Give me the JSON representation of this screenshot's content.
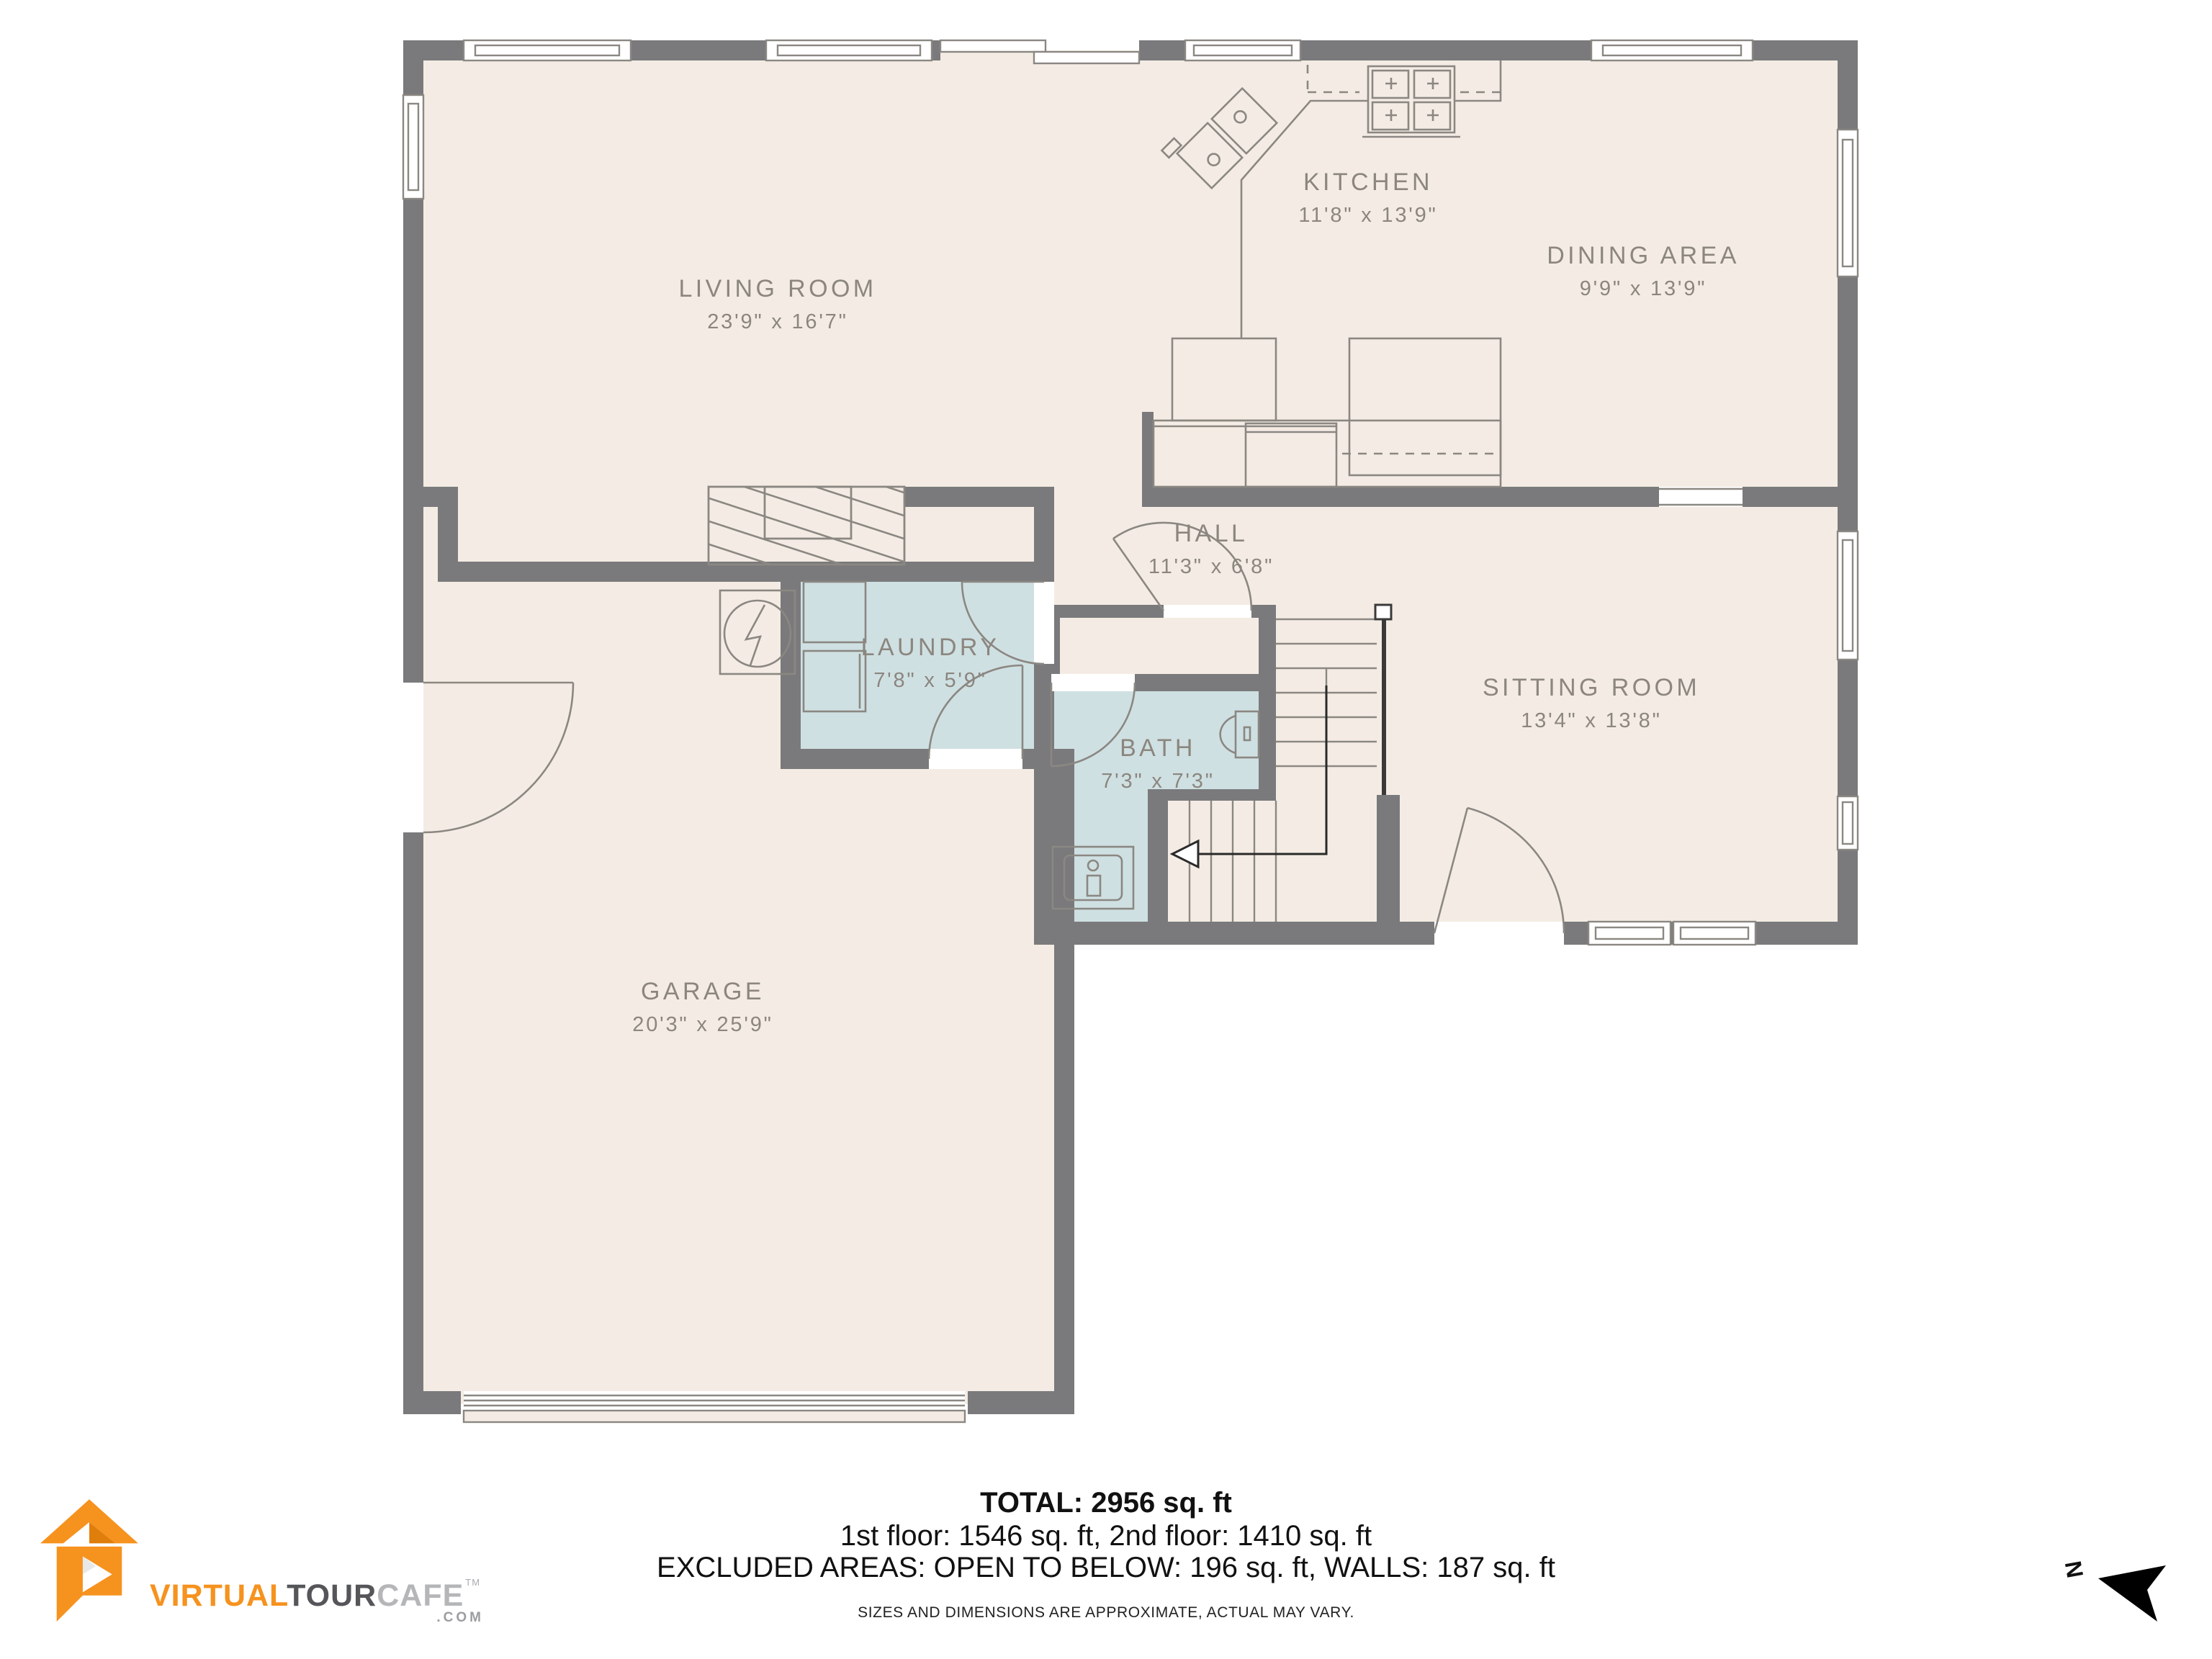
{
  "rooms": [
    {
      "id": "living-room",
      "label": "LIVING ROOM",
      "dims": "23'9\" x 16'7\""
    },
    {
      "id": "kitchen",
      "label": "KITCHEN",
      "dims": "11'8\" x 13'9\""
    },
    {
      "id": "dining-area",
      "label": "DINING AREA",
      "dims": "9'9\" x 13'9\""
    },
    {
      "id": "hall",
      "label": "HALL",
      "dims": "11'3\" x 6'8\""
    },
    {
      "id": "laundry",
      "label": "LAUNDRY",
      "dims": "7'8\" x 5'9\""
    },
    {
      "id": "bath",
      "label": "BATH",
      "dims": "7'3\" x 7'3\""
    },
    {
      "id": "sitting-room",
      "label": "SITTING ROOM",
      "dims": "13'4\" x 13'8\""
    },
    {
      "id": "garage",
      "label": "GARAGE",
      "dims": "20'3\" x 25'9\""
    }
  ],
  "footer": {
    "total": "TOTAL: 2956 sq. ft",
    "floors": "1st floor: 1546 sq. ft, 2nd floor: 1410 sq. ft",
    "excluded": "EXCLUDED AREAS: OPEN TO BELOW: 196 sq. ft, WALLS: 187 sq. ft",
    "disclaimer": "SIZES AND DIMENSIONS ARE APPROXIMATE, ACTUAL MAY VARY."
  },
  "logo": {
    "virtual": "VIRTUAL",
    "tour": "TOUR",
    "cafe": "CAFE",
    "tm": "TM",
    "com": ".COM"
  },
  "compass": {
    "north_label": "N"
  },
  "colors": {
    "floor": "#f4ece4",
    "wet_room": "#cfe0e2",
    "wall": "#7a7a7c",
    "fixture_line": "#8b8782",
    "label_text": "#8b867f",
    "logo_orange": "#f6921e",
    "logo_dark_gray": "#55565a",
    "logo_light_gray": "#b4b6b8"
  }
}
